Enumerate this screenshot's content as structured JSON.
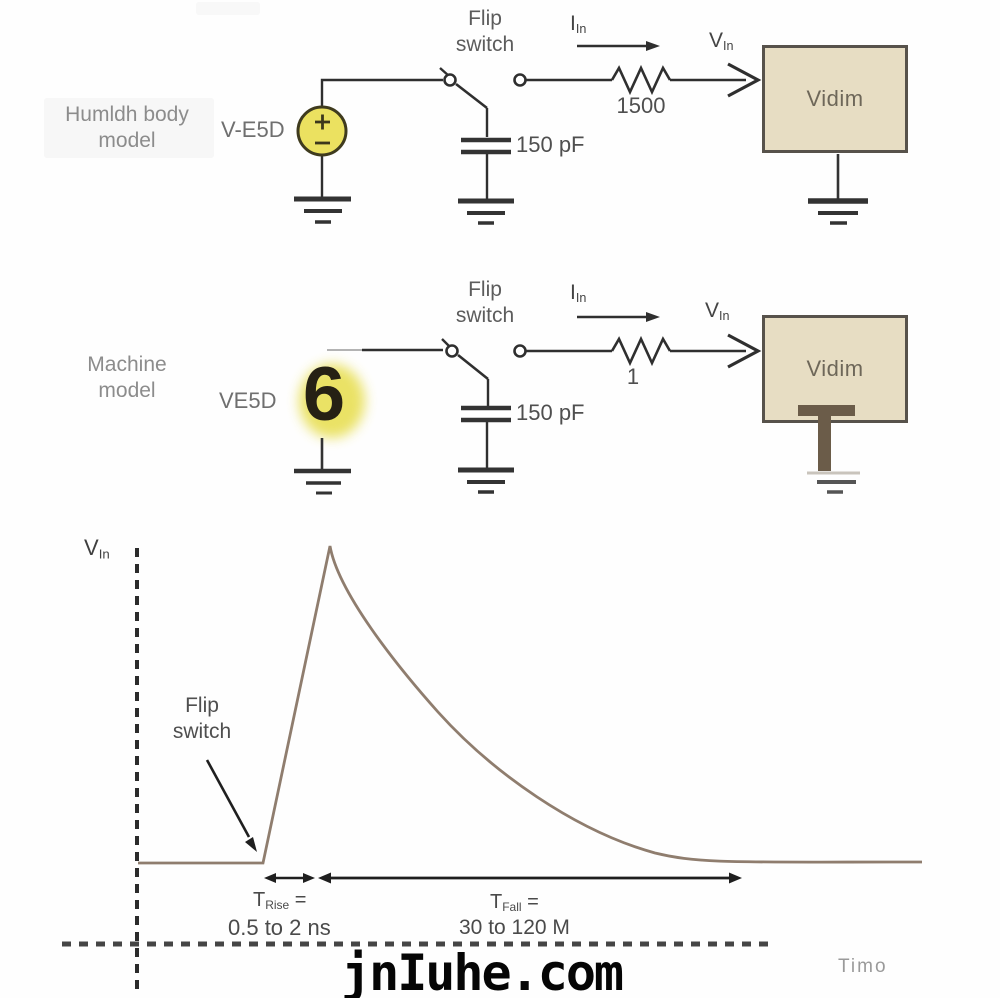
{
  "watermark": "jnIuhe.com",
  "human_body_model": {
    "title_line1": "Humldh body",
    "title_line2": "model",
    "source_label": "V-E5D",
    "flip_switch_line1": "Flip",
    "flip_switch_line2": "switch",
    "current_label": {
      "main": "I",
      "sub": "In"
    },
    "voltage_label": {
      "main": "V",
      "sub": "In"
    },
    "resistor_value": "1500",
    "capacitor_value": "150 pF",
    "device_label": "Vidim"
  },
  "machine_model": {
    "title_line1": "Machine",
    "title_line2": "model",
    "source_label": "VE5D",
    "source_digit": "6",
    "flip_switch_line1": "Flip",
    "flip_switch_line2": "switch",
    "current_label": {
      "main": "I",
      "sub": "In"
    },
    "voltage_label": {
      "main": "V",
      "sub": "In"
    },
    "resistor_value": "1",
    "capacitor_value": "150 pF",
    "device_label": "Vidim"
  },
  "graph": {
    "y_axis_label": {
      "main": "V",
      "sub": "In"
    },
    "x_axis_label": "Timo",
    "annotation_line1": "Flip",
    "annotation_line2": "switch",
    "t_rise_label": {
      "main": "T",
      "sub": "Rise",
      "suffix": " ="
    },
    "t_rise_value": "0.5 to 2 ns",
    "t_fall_label": {
      "main": "T",
      "sub": "Fall",
      "suffix": " ="
    },
    "t_fall_value": "30 to 120 M"
  },
  "chart_data": {
    "type": "line",
    "title": "",
    "xlabel": "Timo",
    "ylabel": "VIn",
    "description": "ESD pulse: flat baseline, fast linear rise at flip-switch instant to a sharp peak, then exponential decay back to baseline",
    "x_axis_style": "dashed, unlabeled time axis",
    "y_axis_style": "dashed, unlabeled voltage axis",
    "points_normalized": [
      [
        0.0,
        0.0
      ],
      [
        0.16,
        0.0
      ],
      [
        0.245,
        1.0
      ],
      [
        0.33,
        0.62
      ],
      [
        0.45,
        0.35
      ],
      [
        0.58,
        0.13
      ],
      [
        0.77,
        0.0
      ],
      [
        1.0,
        0.0
      ]
    ],
    "annotations": [
      "Flip switch (arrow to rise start)",
      "TRise = 0.5 to 2 ns",
      "TFall = 30 to 120 M"
    ]
  },
  "colors": {
    "box_fill": "#e7ddc3",
    "box_border": "#57524b",
    "source_fill": "#ebe160",
    "highlight_yellow": "#e8df55",
    "waveform": "#8f7d6e",
    "wire": "#2f2f2f",
    "overlay_brown": "#6b5c49",
    "watermark_color": "#050505"
  }
}
